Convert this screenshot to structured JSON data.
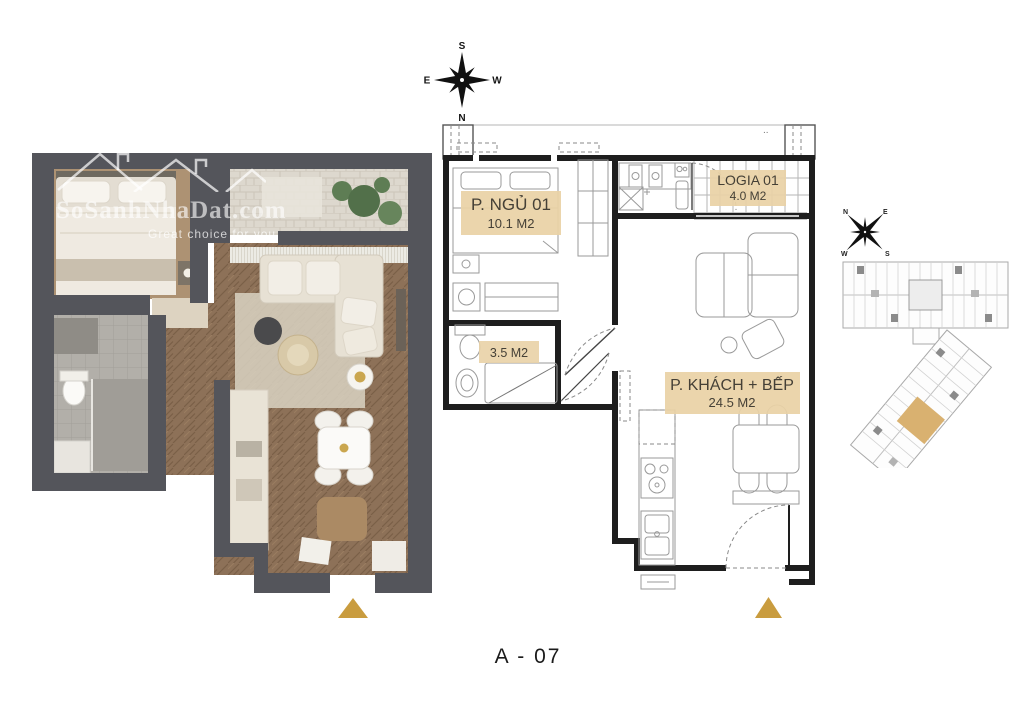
{
  "plan_code": "A - 07",
  "watermark": {
    "brand": "SoSanhNhaDat.com",
    "tagline": "Great choice for you"
  },
  "compass": {
    "top": "S",
    "bottom": "N",
    "left": "E",
    "right": "W"
  },
  "mini_compass": {
    "top_left": "N",
    "top_right": "E",
    "bottom_left": "W",
    "bottom_right": "S"
  },
  "rooms": {
    "bedroom": {
      "name": "P. NGỦ 01",
      "area": "10.1 M2"
    },
    "logia": {
      "name": "LOGIA 01",
      "area": "4.0 M2"
    },
    "bathroom": {
      "area": "3.5 M2"
    },
    "living_kitchen": {
      "name": "P. KHÁCH + BẾP",
      "area": "24.5 M2"
    }
  },
  "decor": {
    "corner_dots": ".."
  },
  "colors": {
    "accent_gold": "#c99c3f",
    "label_bg": "#e9d2a6",
    "wall_3d": "#54555b",
    "line_dark": "#1e1e1e"
  }
}
